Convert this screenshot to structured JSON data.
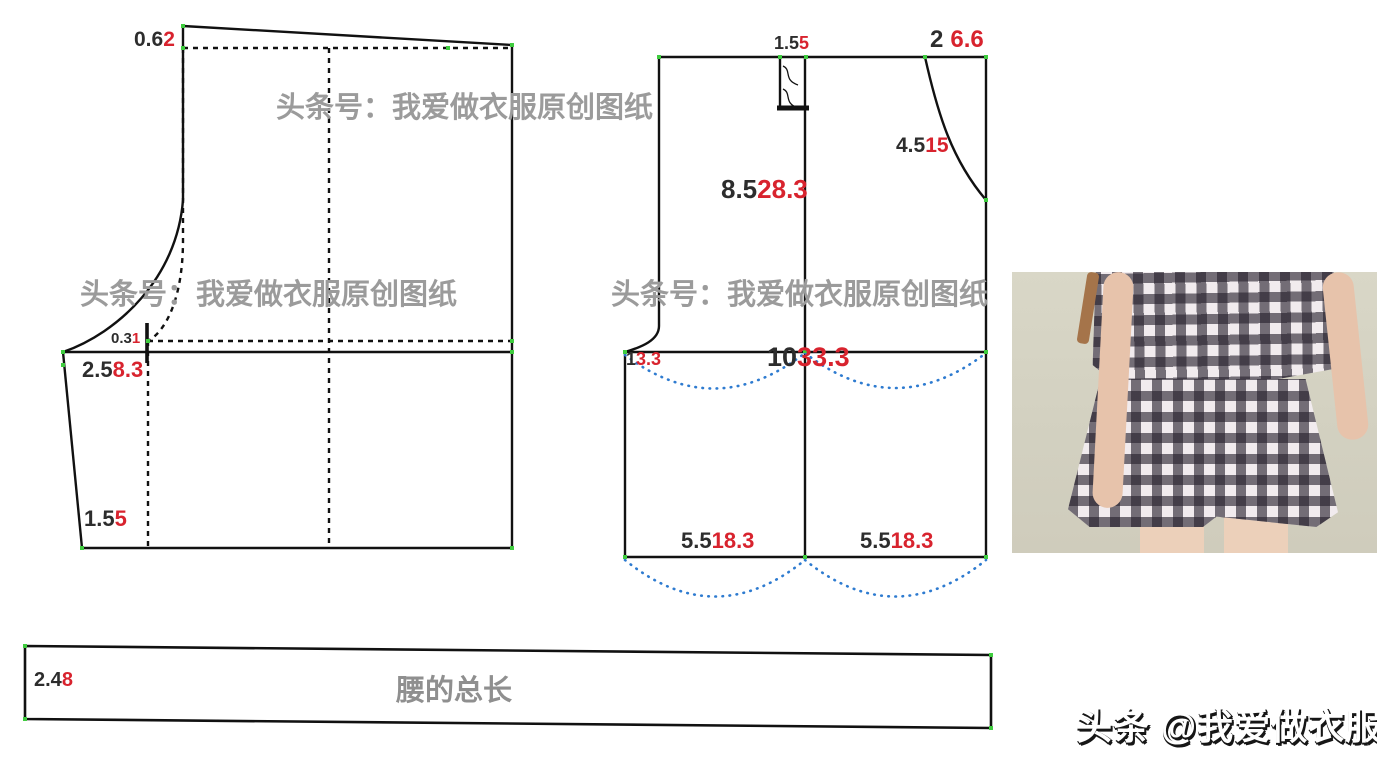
{
  "watermarks": {
    "repeat_text": "头条号：我爱做衣服原创图纸"
  },
  "brand_signature": "头条 @我爱做衣服",
  "piece_left": {
    "top_drop": {
      "base": "0.6",
      "adjusted": "2"
    },
    "waist_notch": {
      "base": "0.3",
      "adjusted": "1"
    },
    "hip_depth": {
      "base": "2.5",
      "adjusted": "8.3"
    },
    "hem_slant": {
      "base": "1.5",
      "adjusted": "5"
    }
  },
  "piece_middle": {
    "fly_width": {
      "base": "1.5",
      "adjusted": "5"
    },
    "pocket_opening": {
      "base": "2",
      "adjusted": "6.6"
    },
    "pocket_depth": {
      "base": "4.5",
      "adjusted": "15"
    },
    "front_rise": {
      "base": "8.5",
      "adjusted": "28.3"
    },
    "crotch_extension": {
      "base": "1",
      "adjusted": "3.3"
    },
    "hip_width": {
      "base": "10",
      "adjusted": "33.3"
    },
    "left_leg_hem": {
      "base": "5.5",
      "adjusted": "18.3"
    },
    "right_leg_hem": {
      "base": "5.5",
      "adjusted": "18.3"
    }
  },
  "waistband": {
    "height": {
      "base": "2.4",
      "adjusted": "8"
    },
    "label": "腰的总长"
  },
  "colors": {
    "pattern_line": "#111111",
    "base_number_text": "#2d2d2d",
    "adjusted_number_text": "#d8232e",
    "watermark_gray": "#9b9b9b",
    "guide_curve_blue": "#2e7bd0",
    "node_green": "#3fcc3f",
    "photo_background": "#d2d0c1"
  }
}
